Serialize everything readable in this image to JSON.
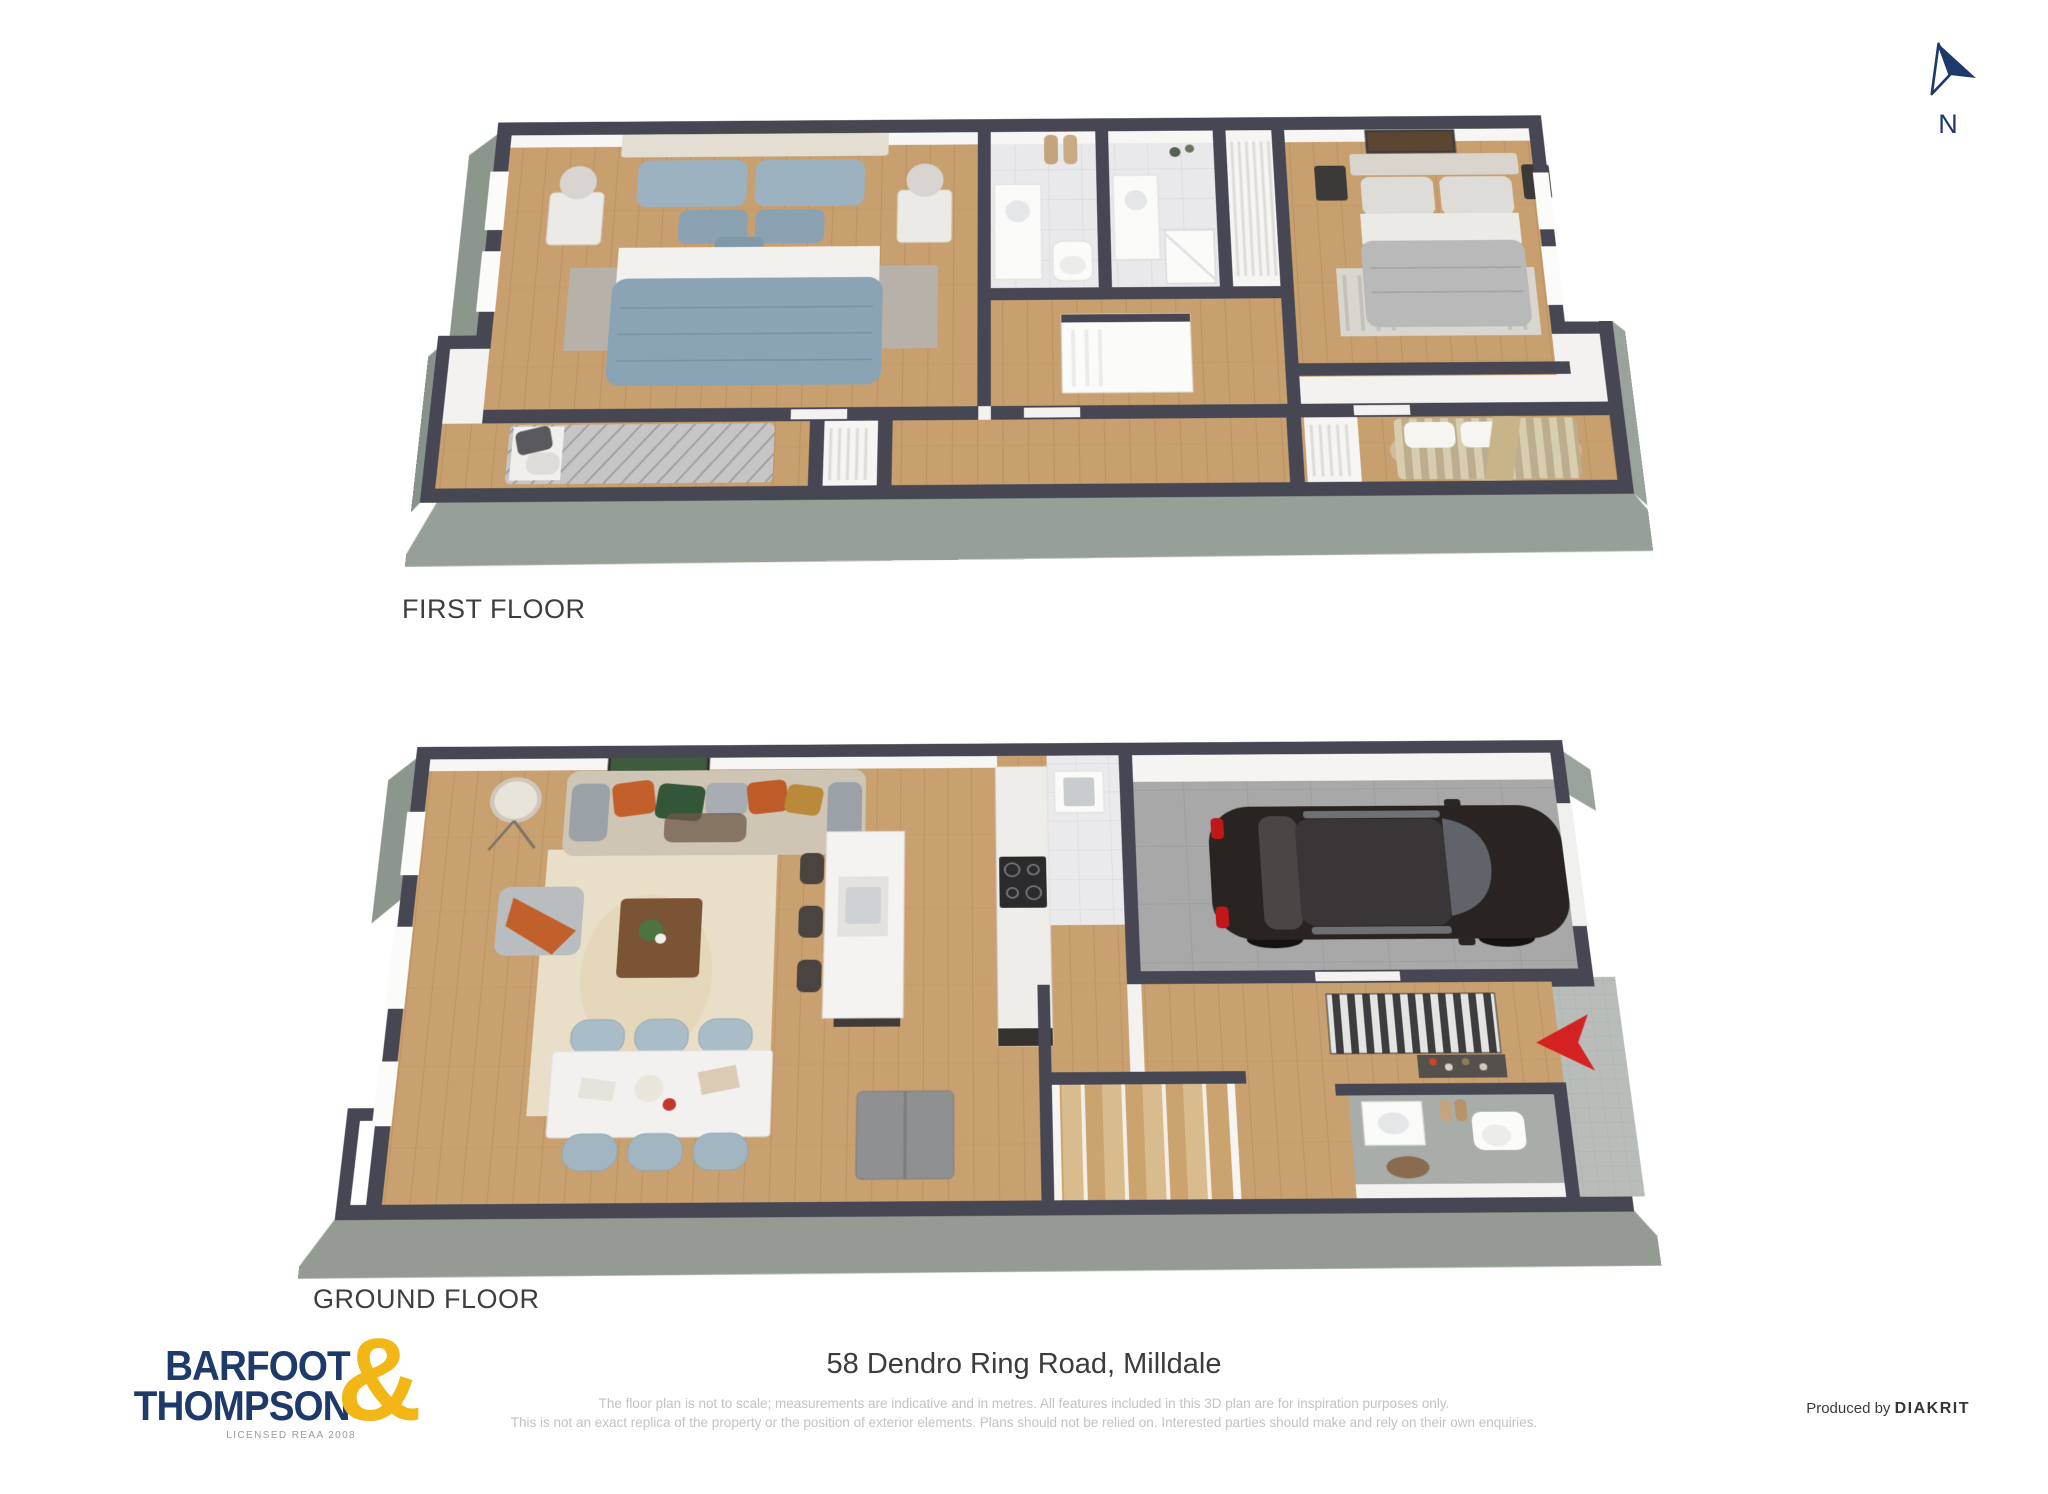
{
  "compass": {
    "label": "N"
  },
  "plans": {
    "first": {
      "label": "FIRST FLOOR"
    },
    "ground": {
      "label": "GROUND FLOOR"
    }
  },
  "footer": {
    "logo_line1": "BARFOOT",
    "logo_line2": "THOMPSON",
    "logo_ampersand": "&",
    "logo_license": "LICENSED REAA 2008",
    "address": "58 Dendro Ring Road, Milldale",
    "disclaimer_line1": "The floor plan is not to scale; measurements are indicative and in metres. All features included in this 3D plan are for inspiration purposes only.",
    "disclaimer_line2": "This is not an exact replica of the property or the position of exterior elements. Plans should not be relied on. Interested parties should make and rely on their own enquiries.",
    "produced_by": "Produced by",
    "producer": "DIAKRIT"
  },
  "icons": {
    "north_arrow": "north-arrow-icon",
    "entry_arrow": "entry-direction-arrow-icon"
  },
  "colors": {
    "brand_navy": "#1d3a6b",
    "brand_gold": "#f2b616",
    "wall_dark": "#474753",
    "wall_side_face": "#97a097",
    "wood_floor": "#c89f6f",
    "entry_arrow_red": "#d42121",
    "label_text": "#3e3e3e",
    "disclaimer_text": "#c2c2c2"
  }
}
